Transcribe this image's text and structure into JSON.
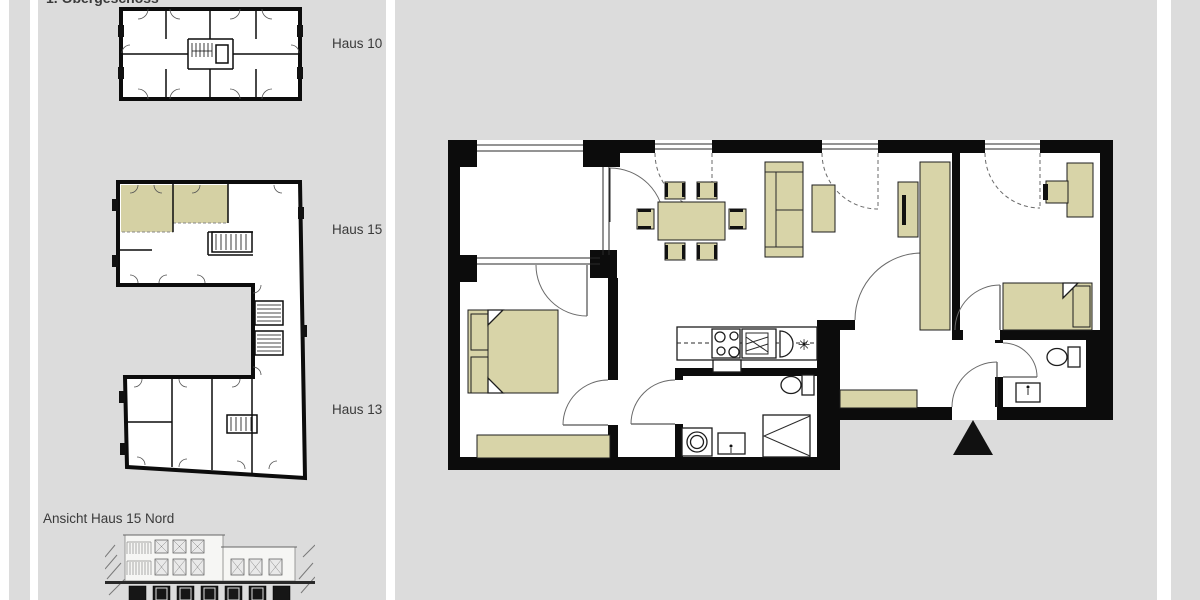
{
  "colors": {
    "background": "#dcdcdc",
    "paper": "#ffffff",
    "wall": "#0c0c0c",
    "furniture": "#d8d4a8",
    "highlight": "#d5d1a4",
    "text": "#3a3a3a"
  },
  "sidebar": {
    "floor_label": "1. Obergeschoss",
    "houses": [
      {
        "label": "Haus 10"
      },
      {
        "label": "Haus 15"
      },
      {
        "label": "Haus 13"
      }
    ],
    "elevation_label": "Ansicht Haus 15 Nord"
  },
  "plan": {
    "fridge_symbol": "✳"
  }
}
